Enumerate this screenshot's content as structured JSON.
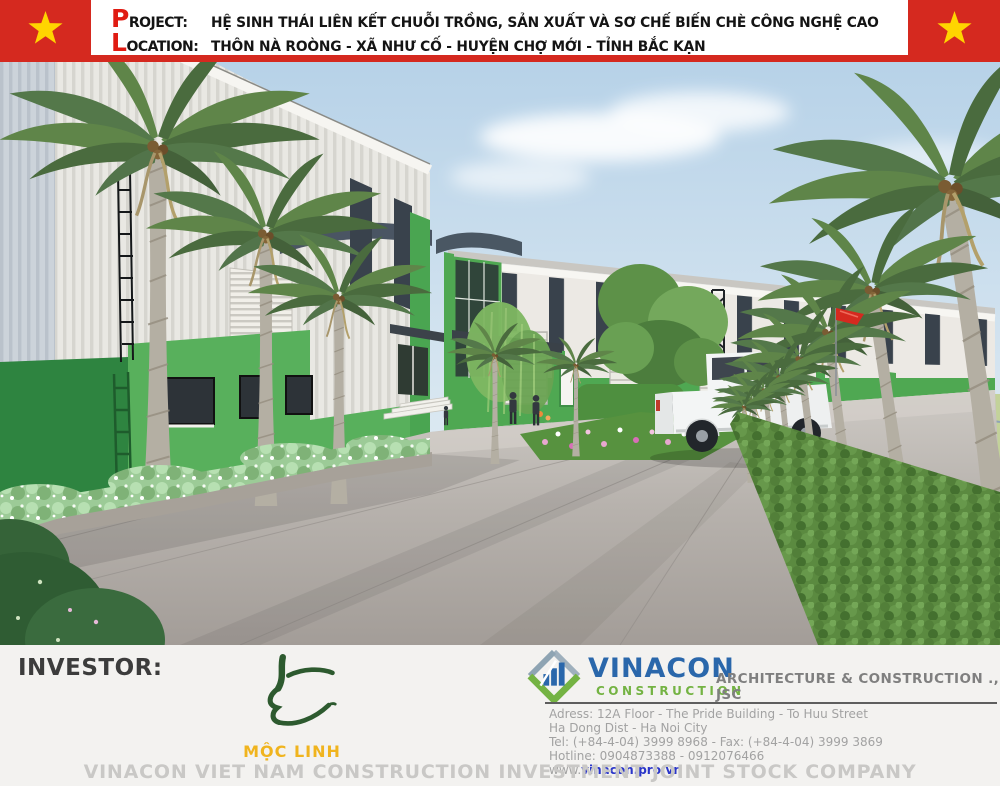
{
  "header": {
    "project_label_initial": "P",
    "project_label_rest": "ROJECT:",
    "project_value": "HỆ SINH THÁI LIÊN KẾT CHUỖI TRỒNG, SẢN XUẤT VÀ SƠ CHẾ BIẾN CHÈ CÔNG NGHỆ CAO",
    "location_label_initial": "L",
    "location_label_rest": "OCATION:",
    "location_value": "THÔN NÀ ROÒNG - XÃ NHƯ CỐ - HUYỆN CHỢ MỚI - TỈNH BẮC KẠN",
    "colors": {
      "flag_red": "#d5291f",
      "star_yellow": "#ffd400"
    }
  },
  "footer": {
    "investor_label": "INVESTOR:",
    "moc_linh": {
      "name": "MỘC LINH",
      "text_color": "#f0b41e",
      "glyph_color": "#2d5a2f"
    },
    "vinacon": {
      "brand": "VINACON",
      "brand_sub": "CONSTRUCTION",
      "tagline": "ARCHITECTURE & CONSTRUCTION ., JSC",
      "address_lines": [
        "Adress: 12A Floor - The Pride Building - To Huu Street",
        "Ha Dong Dist - Ha Noi City",
        "Tel: (+84-4-04) 3999 8968 - Fax: (+84-4-04) 3999 3869",
        "Hotline: 0904873388 - 0912076466"
      ],
      "website_prefix": "www.",
      "website": "vinacon.pro.vn",
      "brand_color": "#2a67ab",
      "brand_sub_color": "#74b343"
    },
    "company_line": "VINACON VIET NAM CONSTRUCTION INVESTMENT JOINT STOCK COMPANY"
  },
  "scene": {
    "palette": {
      "sky": "#bdd6ea",
      "building_white": "#e9e8e3",
      "accent_green": "#4fa852",
      "pavement": "#b3aeaa",
      "palm_green": "#5f8549"
    }
  }
}
